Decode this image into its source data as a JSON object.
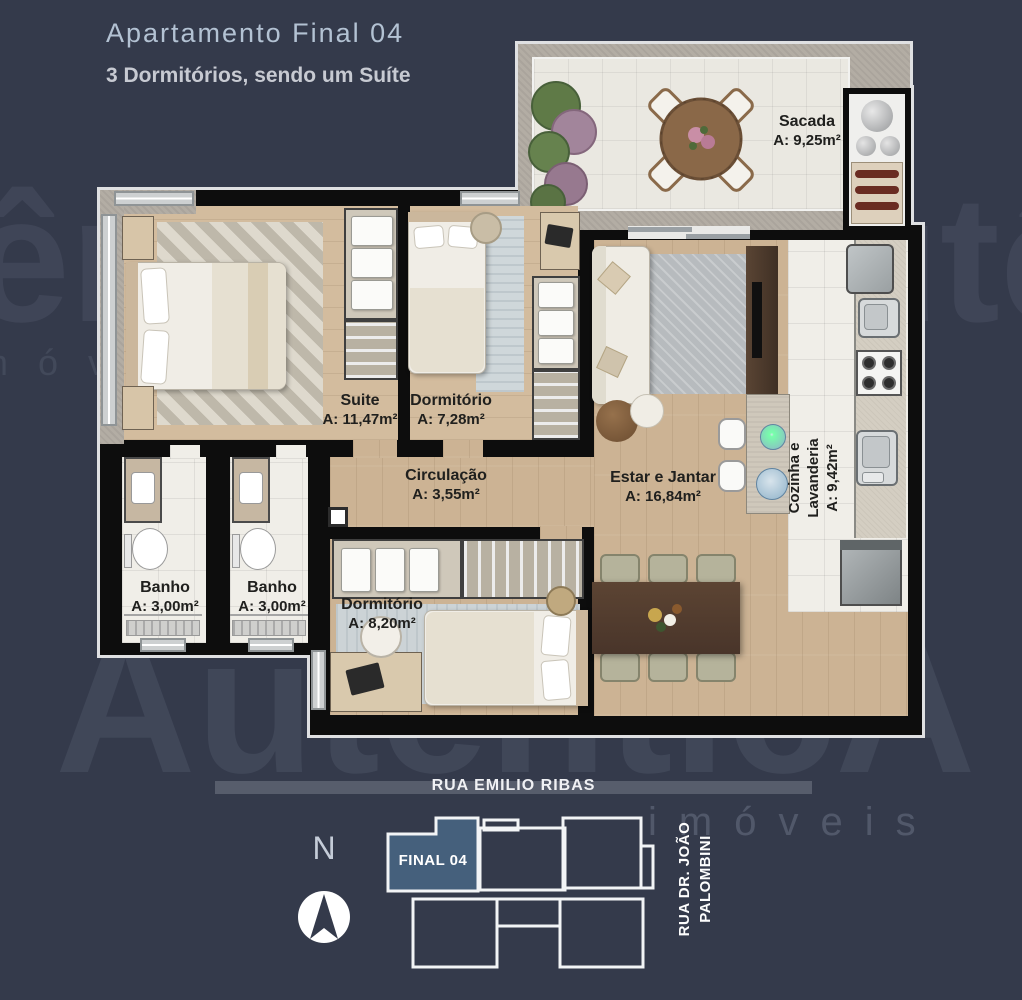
{
  "header": {
    "title": "Apartamento Final 04",
    "subtitle": "3 Dormitórios, sendo um Suíte"
  },
  "rooms": {
    "sacada": {
      "name": "Sacada",
      "area": "A: 9,25m²"
    },
    "suite": {
      "name": "Suite",
      "area": "A: 11,47m²"
    },
    "dormitorio1": {
      "name": "Dormitório",
      "area": "A: 7,28m²"
    },
    "circulacao": {
      "name": "Circulação",
      "area": "A: 3,55m²"
    },
    "estar_jantar": {
      "name": "Estar e Jantar",
      "area": "A: 16,84m²"
    },
    "cozinha_lavanderia": {
      "name": "Cozinha e Lavanderia",
      "area": "A: 9,42m²"
    },
    "banho1": {
      "name": "Banho",
      "area": "A: 3,00m²"
    },
    "banho2": {
      "name": "Banho",
      "area": "A: 3,00m²"
    },
    "dormitorio2": {
      "name": "Dormitório",
      "area": "A: 8,20m²"
    }
  },
  "site_plan": {
    "unit_label": "FINAL 04",
    "street_top": "RUA EMILIO RIBAS",
    "street_right": "RUA DR. JOÃO\nPALOMBINI",
    "compass": "N"
  },
  "watermark": {
    "brand": "AutênticA",
    "subbrand": "imóveis"
  },
  "colors": {
    "background": "#343a4b",
    "unit_highlight": "#45607c",
    "wall": "#0d0d0d",
    "wood_floor": "#ccb394",
    "tile_floor": "#f0eee8",
    "label_text": "#20201e"
  }
}
